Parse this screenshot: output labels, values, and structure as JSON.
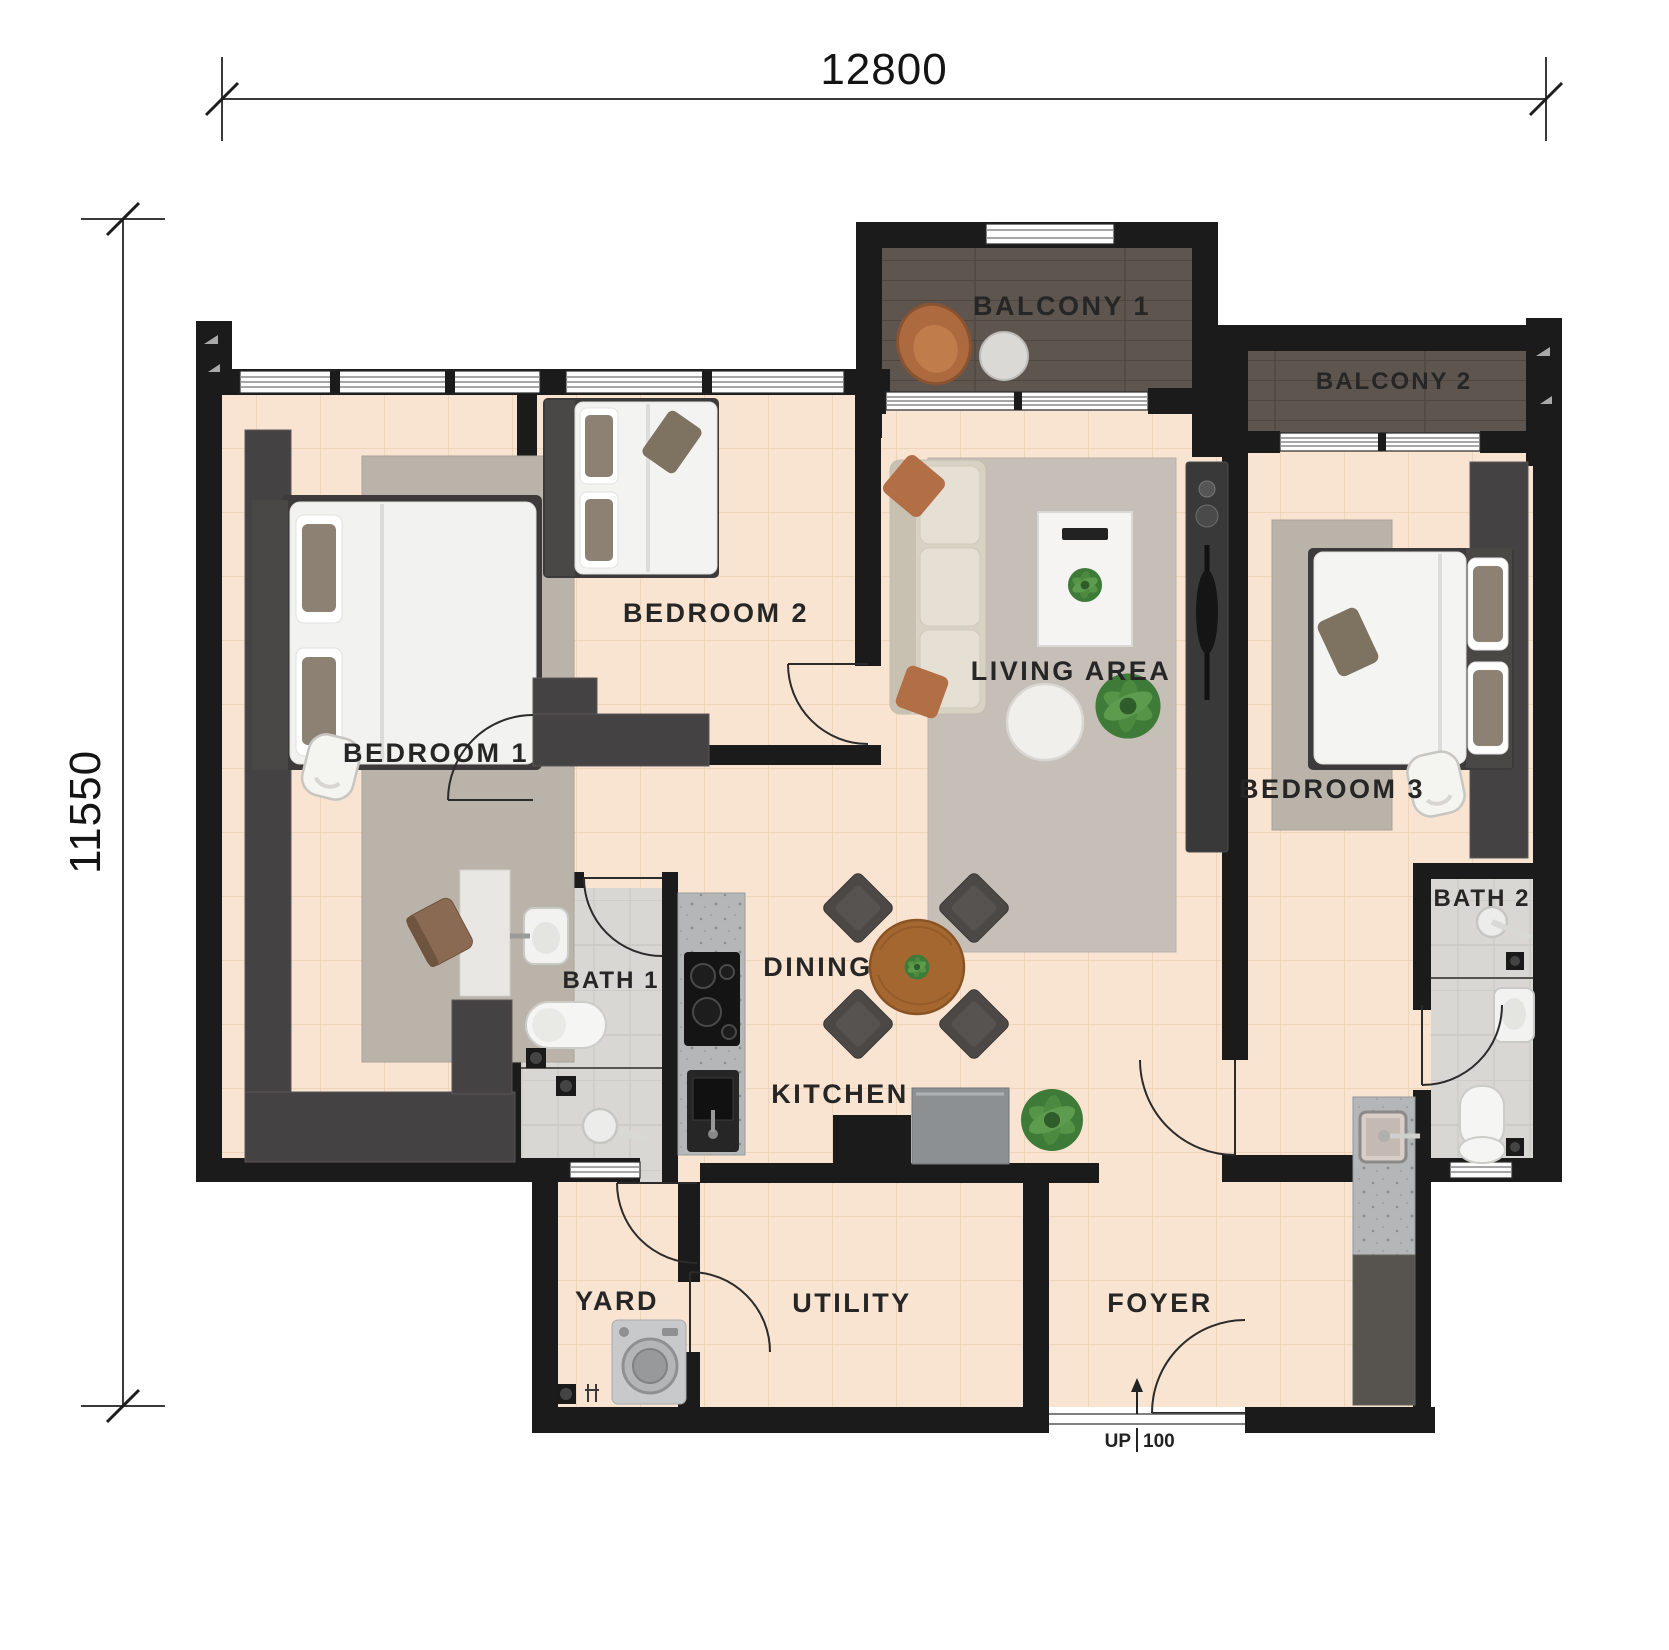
{
  "plan": {
    "dimensions": {
      "width_mm": "12800",
      "height_mm": "11550"
    },
    "rooms": [
      {
        "id": "balcony-1",
        "label": "BALCONY 1"
      },
      {
        "id": "balcony-2",
        "label": "BALCONY 2"
      },
      {
        "id": "bedroom-1",
        "label": "BEDROOM 1"
      },
      {
        "id": "bedroom-2",
        "label": "BEDROOM 2"
      },
      {
        "id": "bedroom-3",
        "label": "BEDROOM 3"
      },
      {
        "id": "living-area",
        "label": "LIVING AREA"
      },
      {
        "id": "dining",
        "label": "DINING"
      },
      {
        "id": "kitchen",
        "label": "KITCHEN"
      },
      {
        "id": "bath-1",
        "label": "BATH 1"
      },
      {
        "id": "bath-2",
        "label": "BATH 2"
      },
      {
        "id": "yard",
        "label": "YARD"
      },
      {
        "id": "utility",
        "label": "UTILITY"
      },
      {
        "id": "foyer",
        "label": "FOYER"
      }
    ],
    "entrance": {
      "up_label": "UP",
      "rise_label": "100"
    },
    "colors": {
      "wall": "#1b1b1b",
      "floor_tile": "#f8e4d1",
      "balcony_floor": "#5d554e",
      "bath_floor": "#d8d7d3",
      "counter_granite": "#b4b6b8",
      "furniture_dark": "#454243",
      "wood_table": "#a4672f",
      "accent_terracotta": "#b26e44",
      "plant_green": "#3f7b38"
    }
  }
}
